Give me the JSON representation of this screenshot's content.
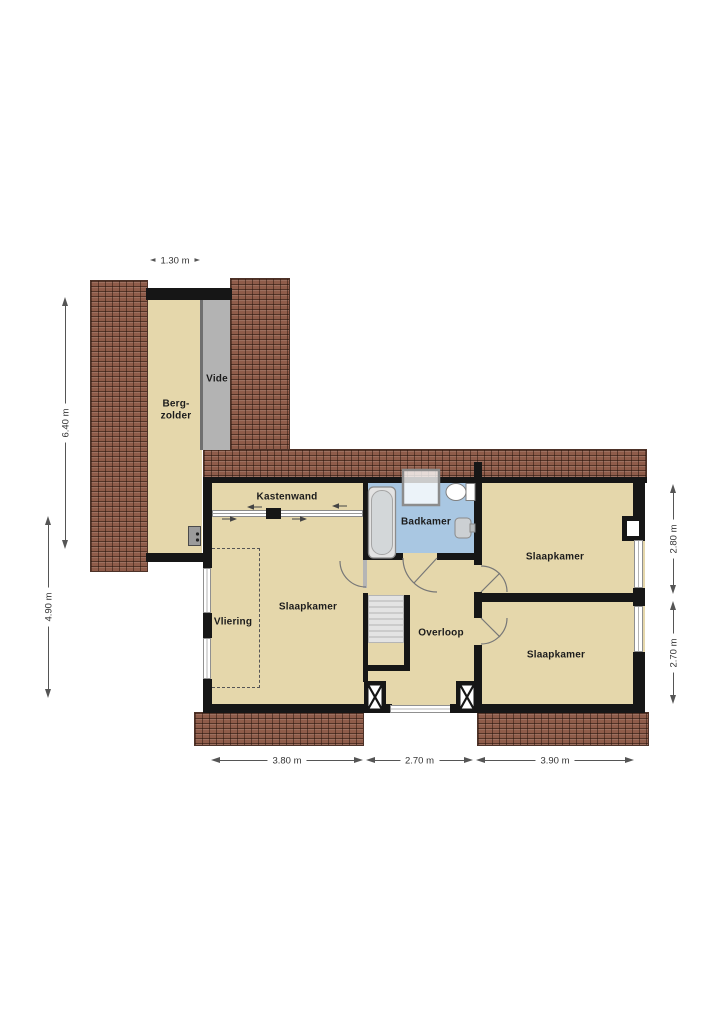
{
  "floorplan": {
    "rooms": {
      "bergzolder": "Berg-\nzolder",
      "vide": "Vide",
      "kastenwand": "Kastenwand",
      "badkamer": "Badkamer",
      "slaapkamer_left": "Slaapkamer",
      "vliering": "Vliering",
      "overloop": "Overloop",
      "slaapkamer_top_right": "Slaapkamer",
      "slaapkamer_bottom_right": "Slaapkamer"
    },
    "dimensions": {
      "top_width": "1.30 m",
      "left_upper": "6.40 m",
      "left_lower": "4.90 m",
      "right_upper": "2.80 m",
      "right_lower": "2.70 m",
      "bottom_left": "3.80 m",
      "bottom_center": "2.70 m",
      "bottom_right": "3.90 m"
    },
    "colors": {
      "floor": "#e5d7ab",
      "roof": "#8f5c4a",
      "wall": "#161616",
      "bathroom_floor": "#a9c7e2",
      "vide_floor": "#b3b3b3",
      "stairs": "#dedede",
      "dimension_text": "#333333"
    },
    "fixtures": {
      "bathtub": "bathtub",
      "shower": "shower-cabin",
      "toilet": "toilet",
      "sink": "washbasin",
      "boiler": "boiler-unit",
      "stairs": "staircase",
      "chimney": "chimney-flue",
      "columns": "masonry-column"
    }
  }
}
